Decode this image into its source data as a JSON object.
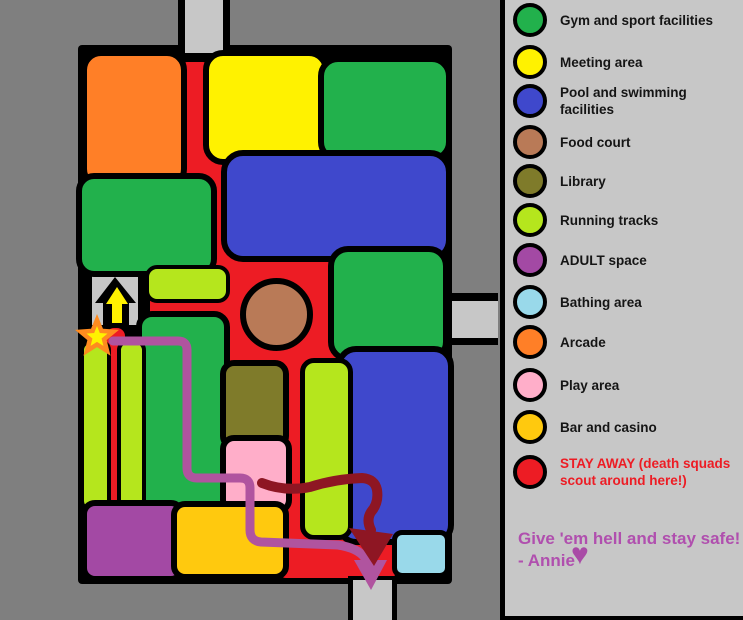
{
  "legend": {
    "items": [
      {
        "id": "gym-and-sport",
        "color": "#22b14c",
        "top": 3,
        "label": "Gym and sport facilities",
        "lines": [
          "Gym and sport facilities"
        ]
      },
      {
        "id": "meeting-area",
        "color": "#fff200",
        "top": 45,
        "label": "Meeting area",
        "lines": [
          "Meeting area"
        ]
      },
      {
        "id": "pool-and-swimming",
        "color": "#3f48cc",
        "top": 84,
        "label": "Pool and swimming facilities",
        "lines": [
          "Pool and swimming",
          "facilities"
        ]
      },
      {
        "id": "food-court",
        "color": "#b97a57",
        "top": 125,
        "label": "Food court",
        "lines": [
          "Food court"
        ]
      },
      {
        "id": "library",
        "color": "#7f7b2a",
        "top": 164,
        "label": "Library",
        "lines": [
          "Library"
        ]
      },
      {
        "id": "running-tracks",
        "color": "#b5e61d",
        "top": 203,
        "label": "Running tracks",
        "lines": [
          "Running tracks"
        ]
      },
      {
        "id": "adult-space",
        "color": "#a349a4",
        "top": 243,
        "label": "ADULT space",
        "lines": [
          "ADULT space"
        ]
      },
      {
        "id": "bathing-area",
        "color": "#99d9ea",
        "top": 285,
        "label": "Bathing area",
        "lines": [
          "Bathing area"
        ]
      },
      {
        "id": "arcade",
        "color": "#ff7f27",
        "top": 325,
        "label": "Arcade",
        "lines": [
          "Arcade"
        ]
      },
      {
        "id": "play-area",
        "color": "#ffaec9",
        "top": 368,
        "label": "Play area",
        "lines": [
          "Play area"
        ]
      },
      {
        "id": "bar-and-casino",
        "color": "#ffc90e",
        "top": 410,
        "label": "Bar and casino",
        "lines": [
          "Bar and casino"
        ]
      },
      {
        "id": "stay-away",
        "color": "#ed1c24",
        "top": 455,
        "text_color": "#ed1c24",
        "label": "STAY AWAY (death squads scout around here!)",
        "lines": [
          "STAY AWAY (death squads",
          "scout around here!)"
        ]
      }
    ],
    "note": {
      "line1": "Give 'em hell and stay safe!",
      "line2": "- Annie",
      "color": "#b04fae",
      "heart": "♥",
      "heart_color": "#a94ba6"
    }
  },
  "map": {
    "background": "#7f7f7f",
    "surface": "#c7c7c7",
    "wall_color": "#000000",
    "danger_color": "#ed1c24",
    "building": {
      "x": 78,
      "y": 45,
      "w": 374,
      "h": 539,
      "r": 4
    },
    "roads": [
      {
        "id": "top-road-border",
        "x": 178,
        "y": 0,
        "w": 52,
        "h": 56,
        "color": "#000000"
      },
      {
        "id": "top-road-fill",
        "x": 185,
        "y": 0,
        "w": 38,
        "h": 53,
        "color": "#c7c7c7"
      },
      {
        "id": "right-road-border",
        "x": 443,
        "y": 293,
        "w": 55,
        "h": 52,
        "color": "#000000"
      },
      {
        "id": "right-road-fill",
        "x": 452,
        "y": 301,
        "w": 46,
        "h": 37,
        "color": "#c7c7c7"
      },
      {
        "id": "bottom-road-border",
        "x": 348,
        "y": 576,
        "w": 49,
        "h": 44,
        "color": "#000000"
      },
      {
        "id": "bottom-road-fill",
        "x": 353,
        "y": 580,
        "w": 39,
        "h": 40,
        "color": "#c7c7c7"
      }
    ],
    "entrance_box": {
      "x": 92,
      "y": 275,
      "w": 46,
      "h": 50,
      "color": "#c7c7c7"
    },
    "red_zones": [
      {
        "x": 177,
        "y": 62,
        "w": 36,
        "h": 130,
        "r": 10
      },
      {
        "x": 177,
        "y": 150,
        "w": 56,
        "h": 125,
        "r": 12
      },
      {
        "x": 150,
        "y": 255,
        "w": 200,
        "h": 162,
        "r": 26
      },
      {
        "x": 106,
        "y": 328,
        "w": 19,
        "h": 177,
        "r": 8
      },
      {
        "x": 278,
        "y": 395,
        "w": 34,
        "h": 152,
        "r": 10
      },
      {
        "x": 278,
        "y": 518,
        "w": 119,
        "h": 60,
        "r": 8
      }
    ],
    "rooms": [
      {
        "id": "arcade",
        "color": "#ff7f27",
        "x": 87,
        "y": 56,
        "w": 94,
        "h": 127,
        "b": 6,
        "r": 20
      },
      {
        "id": "gym-left",
        "color": "#22b14c",
        "x": 82,
        "y": 179,
        "w": 129,
        "h": 92,
        "b": 6,
        "r": 18
      },
      {
        "id": "meeting-area",
        "color": "#fff200",
        "x": 209,
        "y": 56,
        "w": 114,
        "h": 103,
        "b": 6,
        "r": 20
      },
      {
        "id": "gym-top-right",
        "color": "#22b14c",
        "x": 324,
        "y": 62,
        "w": 122,
        "h": 94,
        "b": 6,
        "r": 20
      },
      {
        "id": "pool-top",
        "color": "#3f48cc",
        "x": 227,
        "y": 156,
        "w": 219,
        "h": 100,
        "b": 6,
        "r": 22
      },
      {
        "id": "gym-right",
        "color": "#22b14c",
        "x": 334,
        "y": 252,
        "w": 109,
        "h": 104,
        "b": 6,
        "r": 20
      },
      {
        "id": "pool-bottom",
        "color": "#3f48cc",
        "x": 342,
        "y": 352,
        "w": 106,
        "h": 187,
        "b": 6,
        "r": 20
      },
      {
        "id": "running-track-top",
        "color": "#b5e61d",
        "x": 149,
        "y": 269,
        "w": 77,
        "h": 30,
        "b": 4,
        "r": 12
      },
      {
        "id": "gym-center",
        "color": "#22b14c",
        "x": 142,
        "y": 317,
        "w": 82,
        "h": 192,
        "b": 6,
        "r": 16
      },
      {
        "id": "running-track-left-a",
        "color": "#b5e61d",
        "x": 84,
        "y": 344,
        "w": 23,
        "h": 163,
        "b": 4,
        "r": 10
      },
      {
        "id": "running-track-left-b",
        "color": "#b5e61d",
        "x": 121,
        "y": 344,
        "w": 21,
        "h": 163,
        "b": 4,
        "r": 10
      },
      {
        "id": "running-track-right",
        "color": "#b5e61d",
        "x": 305,
        "y": 363,
        "w": 43,
        "h": 172,
        "b": 5,
        "r": 14
      },
      {
        "id": "library",
        "color": "#7f7b2a",
        "x": 226,
        "y": 366,
        "w": 57,
        "h": 78,
        "b": 6,
        "r": 14
      },
      {
        "id": "play-area",
        "color": "#ffaec9",
        "x": 226,
        "y": 441,
        "w": 60,
        "h": 67,
        "b": 6,
        "r": 14
      },
      {
        "id": "adult-space",
        "color": "#a349a4",
        "x": 87,
        "y": 506,
        "w": 92,
        "h": 70,
        "b": 6,
        "r": 14
      },
      {
        "id": "bar-casino",
        "color": "#ffc90e",
        "x": 177,
        "y": 507,
        "w": 106,
        "h": 67,
        "b": 6,
        "r": 14
      },
      {
        "id": "bathing-area",
        "color": "#99d9ea",
        "x": 397,
        "y": 535,
        "w": 48,
        "h": 38,
        "b": 5,
        "r": 10
      }
    ],
    "food_court_circle": {
      "x": 240,
      "y": 278,
      "d": 73,
      "b": 6,
      "color": "#b97a57"
    },
    "routes": [
      {
        "id": "escape-route",
        "color": "#b0549f",
        "width": 9,
        "d": "M 113 341 L 178 341 Q 187 341 187 350 L 187 468 Q 187 478 197 478 L 240 478 Q 250 478 250 488 L 250 530 Q 250 541 261 542 L 338 545 Q 358 548 365 558 L 369 572",
        "arrow_points": "354 560, 387 560, 371 590"
      },
      {
        "id": "danger-route",
        "color": "#8e1623",
        "width": 10,
        "d": "M 262 483 Q 285 492 310 487 Q 335 479 362 478 Q 375 479 377 490 Q 379 503 371 512 Q 366 520 371 530",
        "arrow_points": "349 528, 393 534, 374 566"
      }
    ],
    "markers": [
      {
        "id": "entry-arrow-outer",
        "points": "115 277, 136 303, 129 303, 129 325, 103 325, 103 303, 95 303",
        "fill": "#000000"
      },
      {
        "id": "entry-arrow-inner",
        "points": "117 287, 128 304, 122 304, 122 323, 112 323, 112 304, 106 304",
        "fill": "#fff200"
      },
      {
        "id": "start-star",
        "points": "97 320, 101.4 330.9, 113.2 331.7, 104.1 339.3, 107 350.8, 97 344.5, 87 350.8, 89.9 339.3, 80.8 331.7, 92.6 330.9",
        "fill": "#fff200",
        "stroke": "#ff8b1f",
        "stroke_width": 4.5
      }
    ]
  }
}
